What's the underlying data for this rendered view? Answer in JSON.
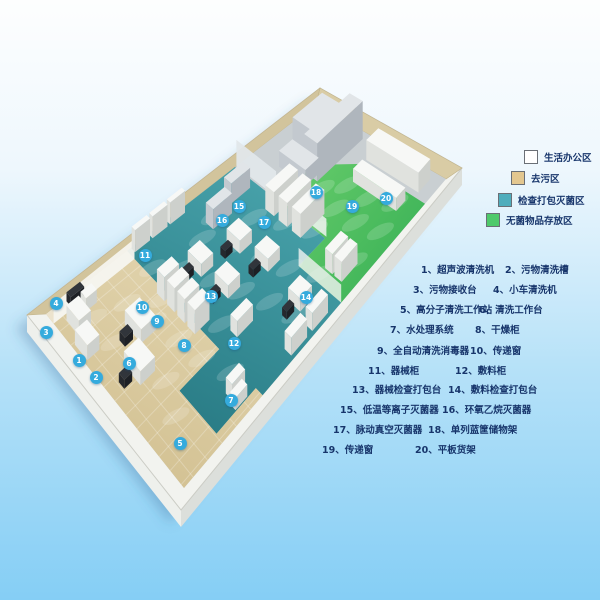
{
  "legend": {
    "items": [
      {
        "label": "生活办公区",
        "color": "#ffffff"
      },
      {
        "label": "去污区",
        "color": "#e3c78f"
      },
      {
        "label": "检查打包灭菌区",
        "color": "#4fadbc"
      },
      {
        "label": "无菌物品存放区",
        "color": "#4ec96b"
      }
    ]
  },
  "equipment_list": {
    "rows": [
      {
        "c1": "1、超声波清洗机",
        "c2": "2、污物清洗槽"
      },
      {
        "c1": "3、污物接收台",
        "c2": "4、小车清洗机"
      },
      {
        "c1": "5、高分子清洗工作站",
        "c2": "6、清洗工作台"
      },
      {
        "c1": "7、水处理系统",
        "c2": "8、干燥柜"
      },
      {
        "c1": "9、全自动清洗消毒器",
        "c2": "10、传递窗"
      },
      {
        "c1": "11、器械柜",
        "c2": "12、敷料柜"
      },
      {
        "c1": "13、器械检查打包台",
        "c2": "14、敷料检查打包台"
      },
      {
        "c1": "15、低温等离子灭菌器",
        "c2": "16、环氧乙烷灭菌器"
      },
      {
        "c1": "17、脉动真空灭菌器",
        "c2": "18、单列蓝筐储物架"
      },
      {
        "c1": "19、传递窗",
        "c2": "20、平板货架"
      }
    ]
  },
  "markers": [
    {
      "n": "1"
    },
    {
      "n": "2"
    },
    {
      "n": "3"
    },
    {
      "n": "4"
    },
    {
      "n": "5"
    },
    {
      "n": "6"
    },
    {
      "n": "7"
    },
    {
      "n": "8"
    },
    {
      "n": "9"
    },
    {
      "n": "10"
    },
    {
      "n": "11"
    },
    {
      "n": "12"
    },
    {
      "n": "13"
    },
    {
      "n": "14"
    },
    {
      "n": "15"
    },
    {
      "n": "16"
    },
    {
      "n": "17"
    },
    {
      "n": "18"
    },
    {
      "n": "19"
    },
    {
      "n": "20"
    }
  ],
  "colors": {
    "background_top": "#fdfefe",
    "background_bottom": "#85cef5",
    "marker_dot": "#35abdd",
    "zone_office": "#ece3cd",
    "zone_decontam": "#dccfa6",
    "zone_pack_sterilize": "#3e98a0",
    "zone_sterile_storage": "#54c463",
    "list_text": "#17356b"
  }
}
